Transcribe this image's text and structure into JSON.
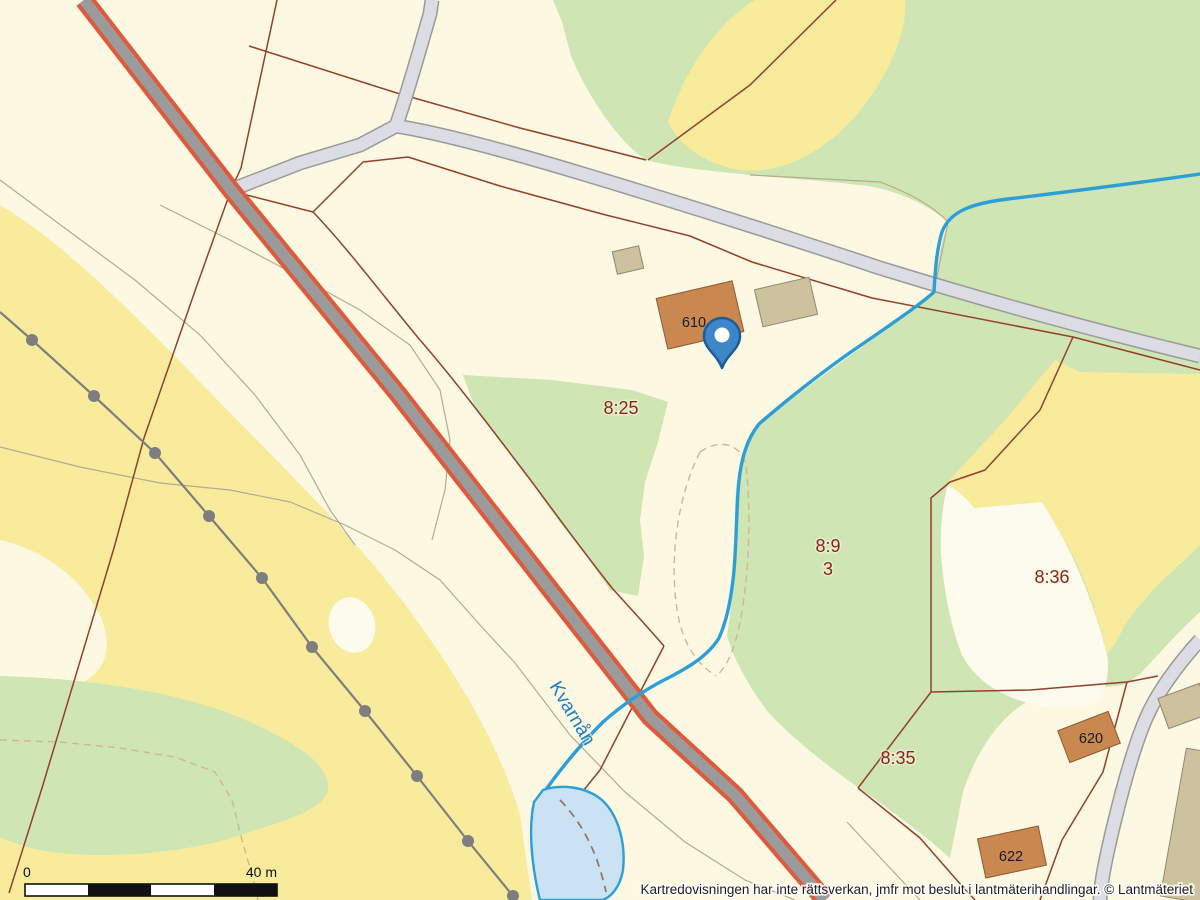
{
  "map": {
    "attribution": "Kartredovisningen har inte rättsverkan, jmfr mot beslut i lantmäterihandlingar. © Lantmäteriet",
    "scale_bar": {
      "start_label": "0",
      "end_label": "40 m"
    },
    "labels": {
      "parcel_825": "8:25",
      "parcel_89": "8:9",
      "parcel_89_sub": "3",
      "parcel_836": "8:36",
      "parcel_835": "8:35",
      "building_610": "610",
      "building_620": "620",
      "building_622": "622",
      "watercourse": "Kvarnån"
    },
    "colors": {
      "cream": "#FCF8E2",
      "field_yellow": "#F8EB9C",
      "forest_green": "#CFE5B3",
      "open_white": "#FCFBEE",
      "water_fill": "#CBE1F4",
      "water_stroke": "#2D9FD8",
      "water_label_blue": "#1E7EC1",
      "road_main_core": "#9B9B9B",
      "road_main_edge": "#DF5A3C",
      "road_sec_fill": "#DBDCE4",
      "road_casing": "#9A9A9A",
      "boundary_red": "#94402C",
      "dashed_tan": "#CBB894",
      "dash_dark": "#8A7666",
      "faint_path": "#B5AB90",
      "powerline": "#7E7E7E",
      "building_fill": "#C98850",
      "building_stroke": "#8F5A33",
      "outbuilding_fill": "#CEC19E",
      "outbuilding_stroke": "#8E8872",
      "label_red": "#8C2418",
      "label_black": "#1A1A1A",
      "pin_fill": "#3D86C9",
      "pin_stroke": "#1D5C95"
    }
  }
}
